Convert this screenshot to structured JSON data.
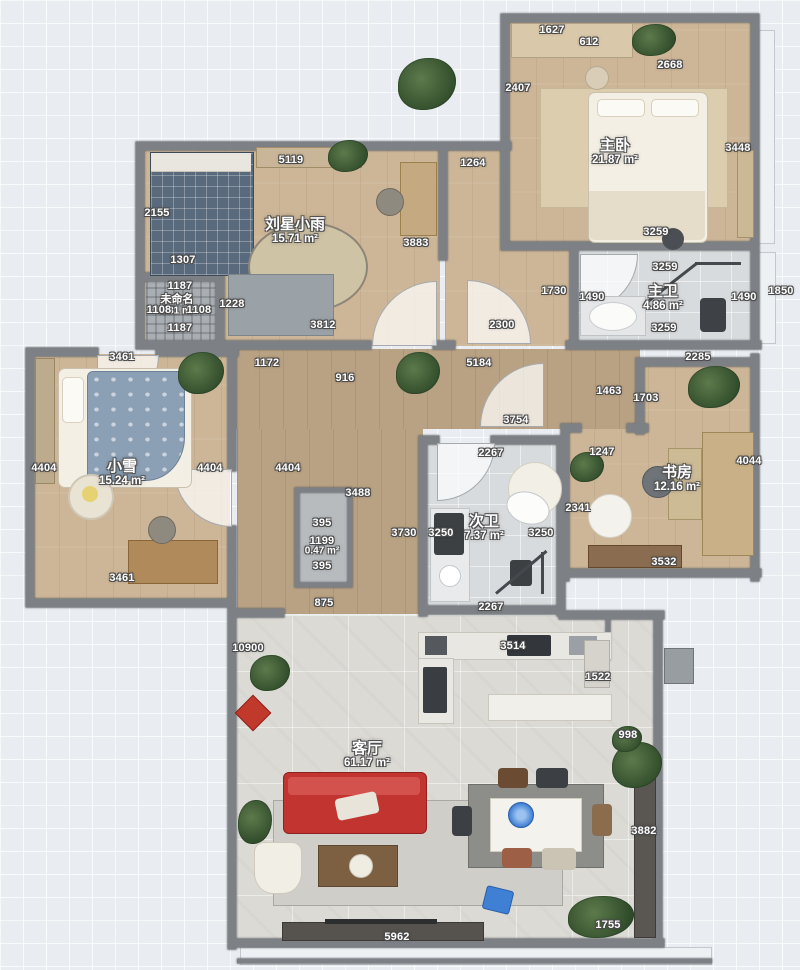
{
  "rooms": [
    {
      "name": "主卧",
      "area": "21.87 m²"
    },
    {
      "name": "刘星小雨",
      "area": "15.71 m²"
    },
    {
      "name": "主卫",
      "area": "4.86 m²"
    },
    {
      "name": "未命名",
      "area": "1.31 m²"
    },
    {
      "name": "小雪",
      "area": "15.24 m²"
    },
    {
      "name": "书房",
      "area": "12.16 m²"
    },
    {
      "name": "次卫",
      "area": "7.37 m²"
    },
    {
      "name": "",
      "area": "0.47 m²"
    },
    {
      "name": "客厅",
      "area": "61.17 m²"
    }
  ],
  "dims": [
    "1627",
    "612",
    "2407",
    "2668",
    "3448",
    "3259",
    "5119",
    "1264",
    "2155",
    "3883",
    "1307",
    "1187",
    "1108",
    "1108",
    "1228",
    "1187",
    "1730",
    "1490",
    "3259",
    "1490",
    "1850",
    "3259",
    "3812",
    "2300",
    "3461",
    "1172",
    "916",
    "5184",
    "2285",
    "1463",
    "1703",
    "3754",
    "4404",
    "4404",
    "4404",
    "2267",
    "1247",
    "4044",
    "2341",
    "3488",
    "395",
    "1199",
    "395",
    "3730",
    "3250",
    "3250",
    "3461",
    "3532",
    "2267",
    "875",
    "10900",
    "3514",
    "1522",
    "998",
    "3882",
    "1755",
    "5962"
  ],
  "colors": {
    "wall": "#7d8186",
    "wood": "#cdb697",
    "hall_wood": "#b9a183",
    "tile": "#d8dbdd",
    "living_tile": "#dbdad5",
    "sofa_red": "#c23430",
    "accent_blue": "#3f7fd4",
    "plant_green": "#3e5c36"
  }
}
